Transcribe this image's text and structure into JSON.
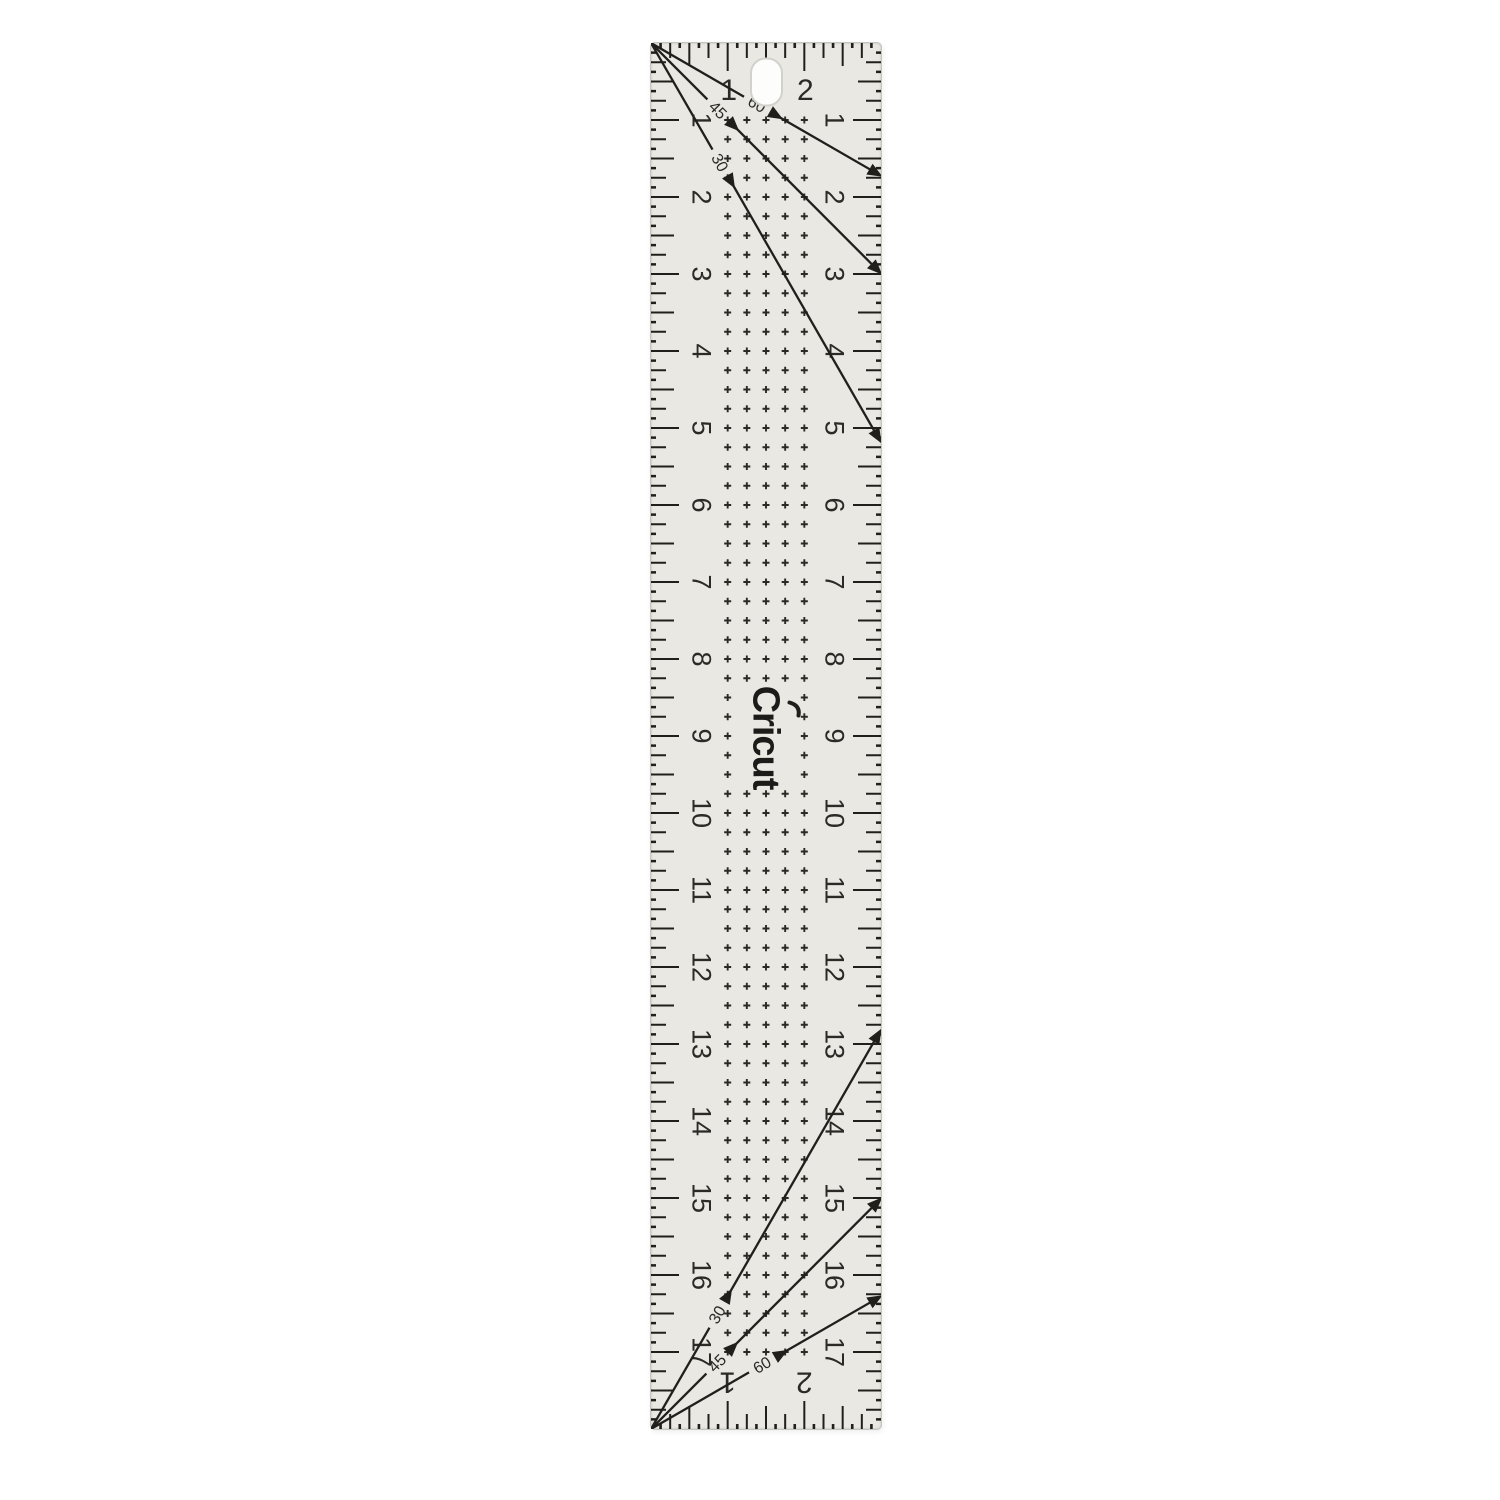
{
  "background_color": "#ffffff",
  "brand": {
    "logo_text": "Cricut"
  },
  "ruler": {
    "x": 650,
    "y": 42,
    "width_px": 230,
    "height_px": 1386,
    "width_in": 3,
    "length_in": 18,
    "body_color": "#e9e8e2",
    "edge_color": "#c6c5bf",
    "mark_color": "#211f1c",
    "number_color": "#2b2a26",
    "side_numbers": [
      1,
      2,
      3,
      4,
      5,
      6,
      7,
      8,
      9,
      10,
      11,
      12,
      13,
      14,
      15,
      16,
      17
    ],
    "top_scale_numbers": [
      {
        "label": "1",
        "inch": 1
      },
      {
        "label": "2",
        "inch": 2
      }
    ],
    "bottom_scale_numbers": [
      {
        "label": "1",
        "inch": 1
      },
      {
        "label": "2",
        "inch": 2
      }
    ],
    "ticks": {
      "per_inch": 8,
      "inch": 28,
      "half": 23,
      "quarter": 15,
      "eighth": 5
    },
    "grid": {
      "symbol": "plus",
      "cols_in": [
        1,
        1.25,
        1.5,
        1.75,
        2
      ],
      "row_start_in": 1,
      "row_end_in": 17,
      "step_in": 0.25,
      "logo_gap_rows": [
        34,
        38
      ],
      "size": 7
    },
    "angle_lines": {
      "top": [
        {
          "label": "60",
          "deg": 60,
          "label_x": 106
        },
        {
          "label": "45",
          "deg": 45,
          "label_x": 67
        },
        {
          "label": "30",
          "deg": 30,
          "label_x": 69
        }
      ],
      "bottom": [
        {
          "label": "30",
          "deg": 30,
          "label_x": 66
        },
        {
          "label": "45",
          "deg": 45,
          "label_x": 66
        },
        {
          "label": "60",
          "deg": 60,
          "label_x": 111
        }
      ]
    },
    "hole": {
      "cx": 115.5,
      "cy": 39,
      "w": 31,
      "h": 47,
      "color": "#fdfdfc"
    }
  }
}
